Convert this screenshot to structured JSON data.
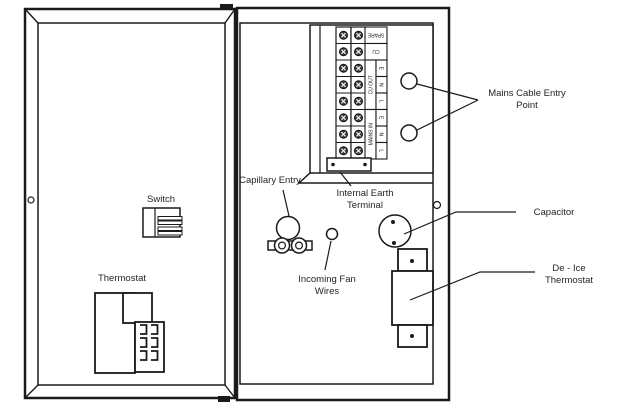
{
  "diagram": {
    "title_context": "Electrical enclosure internal layout diagram",
    "labels": {
      "switch": "Switch",
      "thermostat": "Thermostat",
      "capillary_entry": "Capillary Entry",
      "internal_earth_1": "Internal Earth",
      "internal_earth_2": "Terminal",
      "incoming_fan_1": "Incoming Fan",
      "incoming_fan_2": "Wires",
      "mains_entry_1": "Mains Cable Entry",
      "mains_entry_2": "Point",
      "capacitor": "Capacitor",
      "deice_1": "De - Ice",
      "deice_2": "Thermostat"
    },
    "terminal_block": {
      "spare_label": "SPARE",
      "cu_label": "CU",
      "cu_out_group_label": "CU OUT",
      "mains_in_group_label": "MAINS IN",
      "cu_out_terminals": [
        "E",
        "N",
        "L"
      ],
      "mains_in_terminals": [
        "E",
        "N",
        "L"
      ],
      "rows": 8,
      "screw_columns": 2
    },
    "colors": {
      "line": "#1a1a1a",
      "text": "#23232e",
      "background": "#ffffff"
    }
  }
}
